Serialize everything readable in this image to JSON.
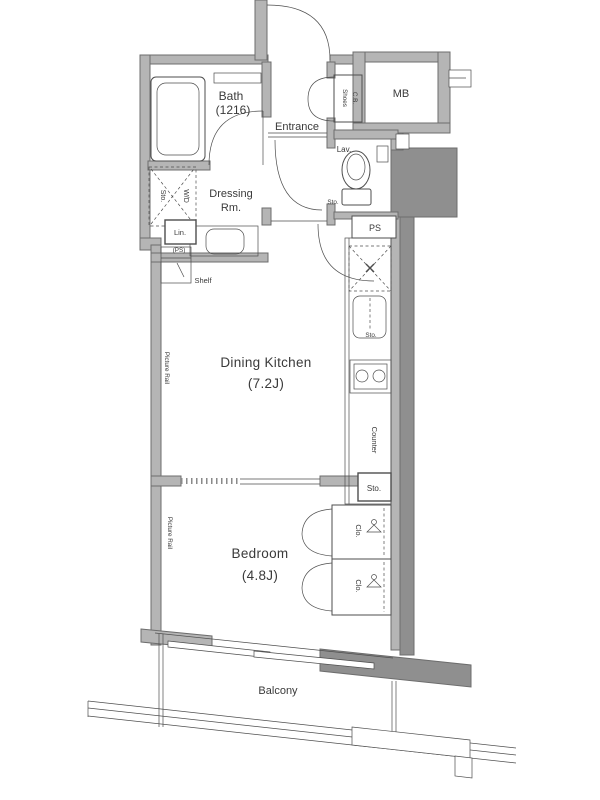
{
  "colors": {
    "background": "#ffffff",
    "wall_fill": "#b5b5b5",
    "wall_edge": "#6d6d6d",
    "void_fill": "#8f8f8f",
    "line": "#4e4e4e",
    "text": "#3a3a3a"
  },
  "rooms": {
    "bath": {
      "name": "Bath",
      "size": "(1216)"
    },
    "entrance": {
      "name": "Entrance"
    },
    "lavatory": {
      "name": "Lav."
    },
    "dressing": {
      "name": "Dressing",
      "name2": "Rm."
    },
    "dining_kitchen": {
      "name": "Dining Kitchen",
      "size": "(7.2J)"
    },
    "bedroom": {
      "name": "Bedroom",
      "size": "(4.8J)"
    },
    "balcony": {
      "name": "Balcony"
    }
  },
  "fixtures": {
    "meter_box": "MB",
    "shoes_cabinet_line1": "Shoes",
    "shoes_cabinet_line2": "C.B.",
    "pipe_space": "PS",
    "linen": "Lin.",
    "linen_pipe_space": "(PS)",
    "washer_dryer": "W/D",
    "washer_storage": "Sto.",
    "toilet_storage": "Sto.",
    "shelf": "Shelf",
    "sink_storage": "Sto.",
    "counter": "Counter",
    "kitchen_storage": "Sto.",
    "closet_upper": "Clo.",
    "closet_lower": "Clo.",
    "picture_rail_dk": "Picture Rail",
    "picture_rail_bedroom": "Picture Rail"
  }
}
